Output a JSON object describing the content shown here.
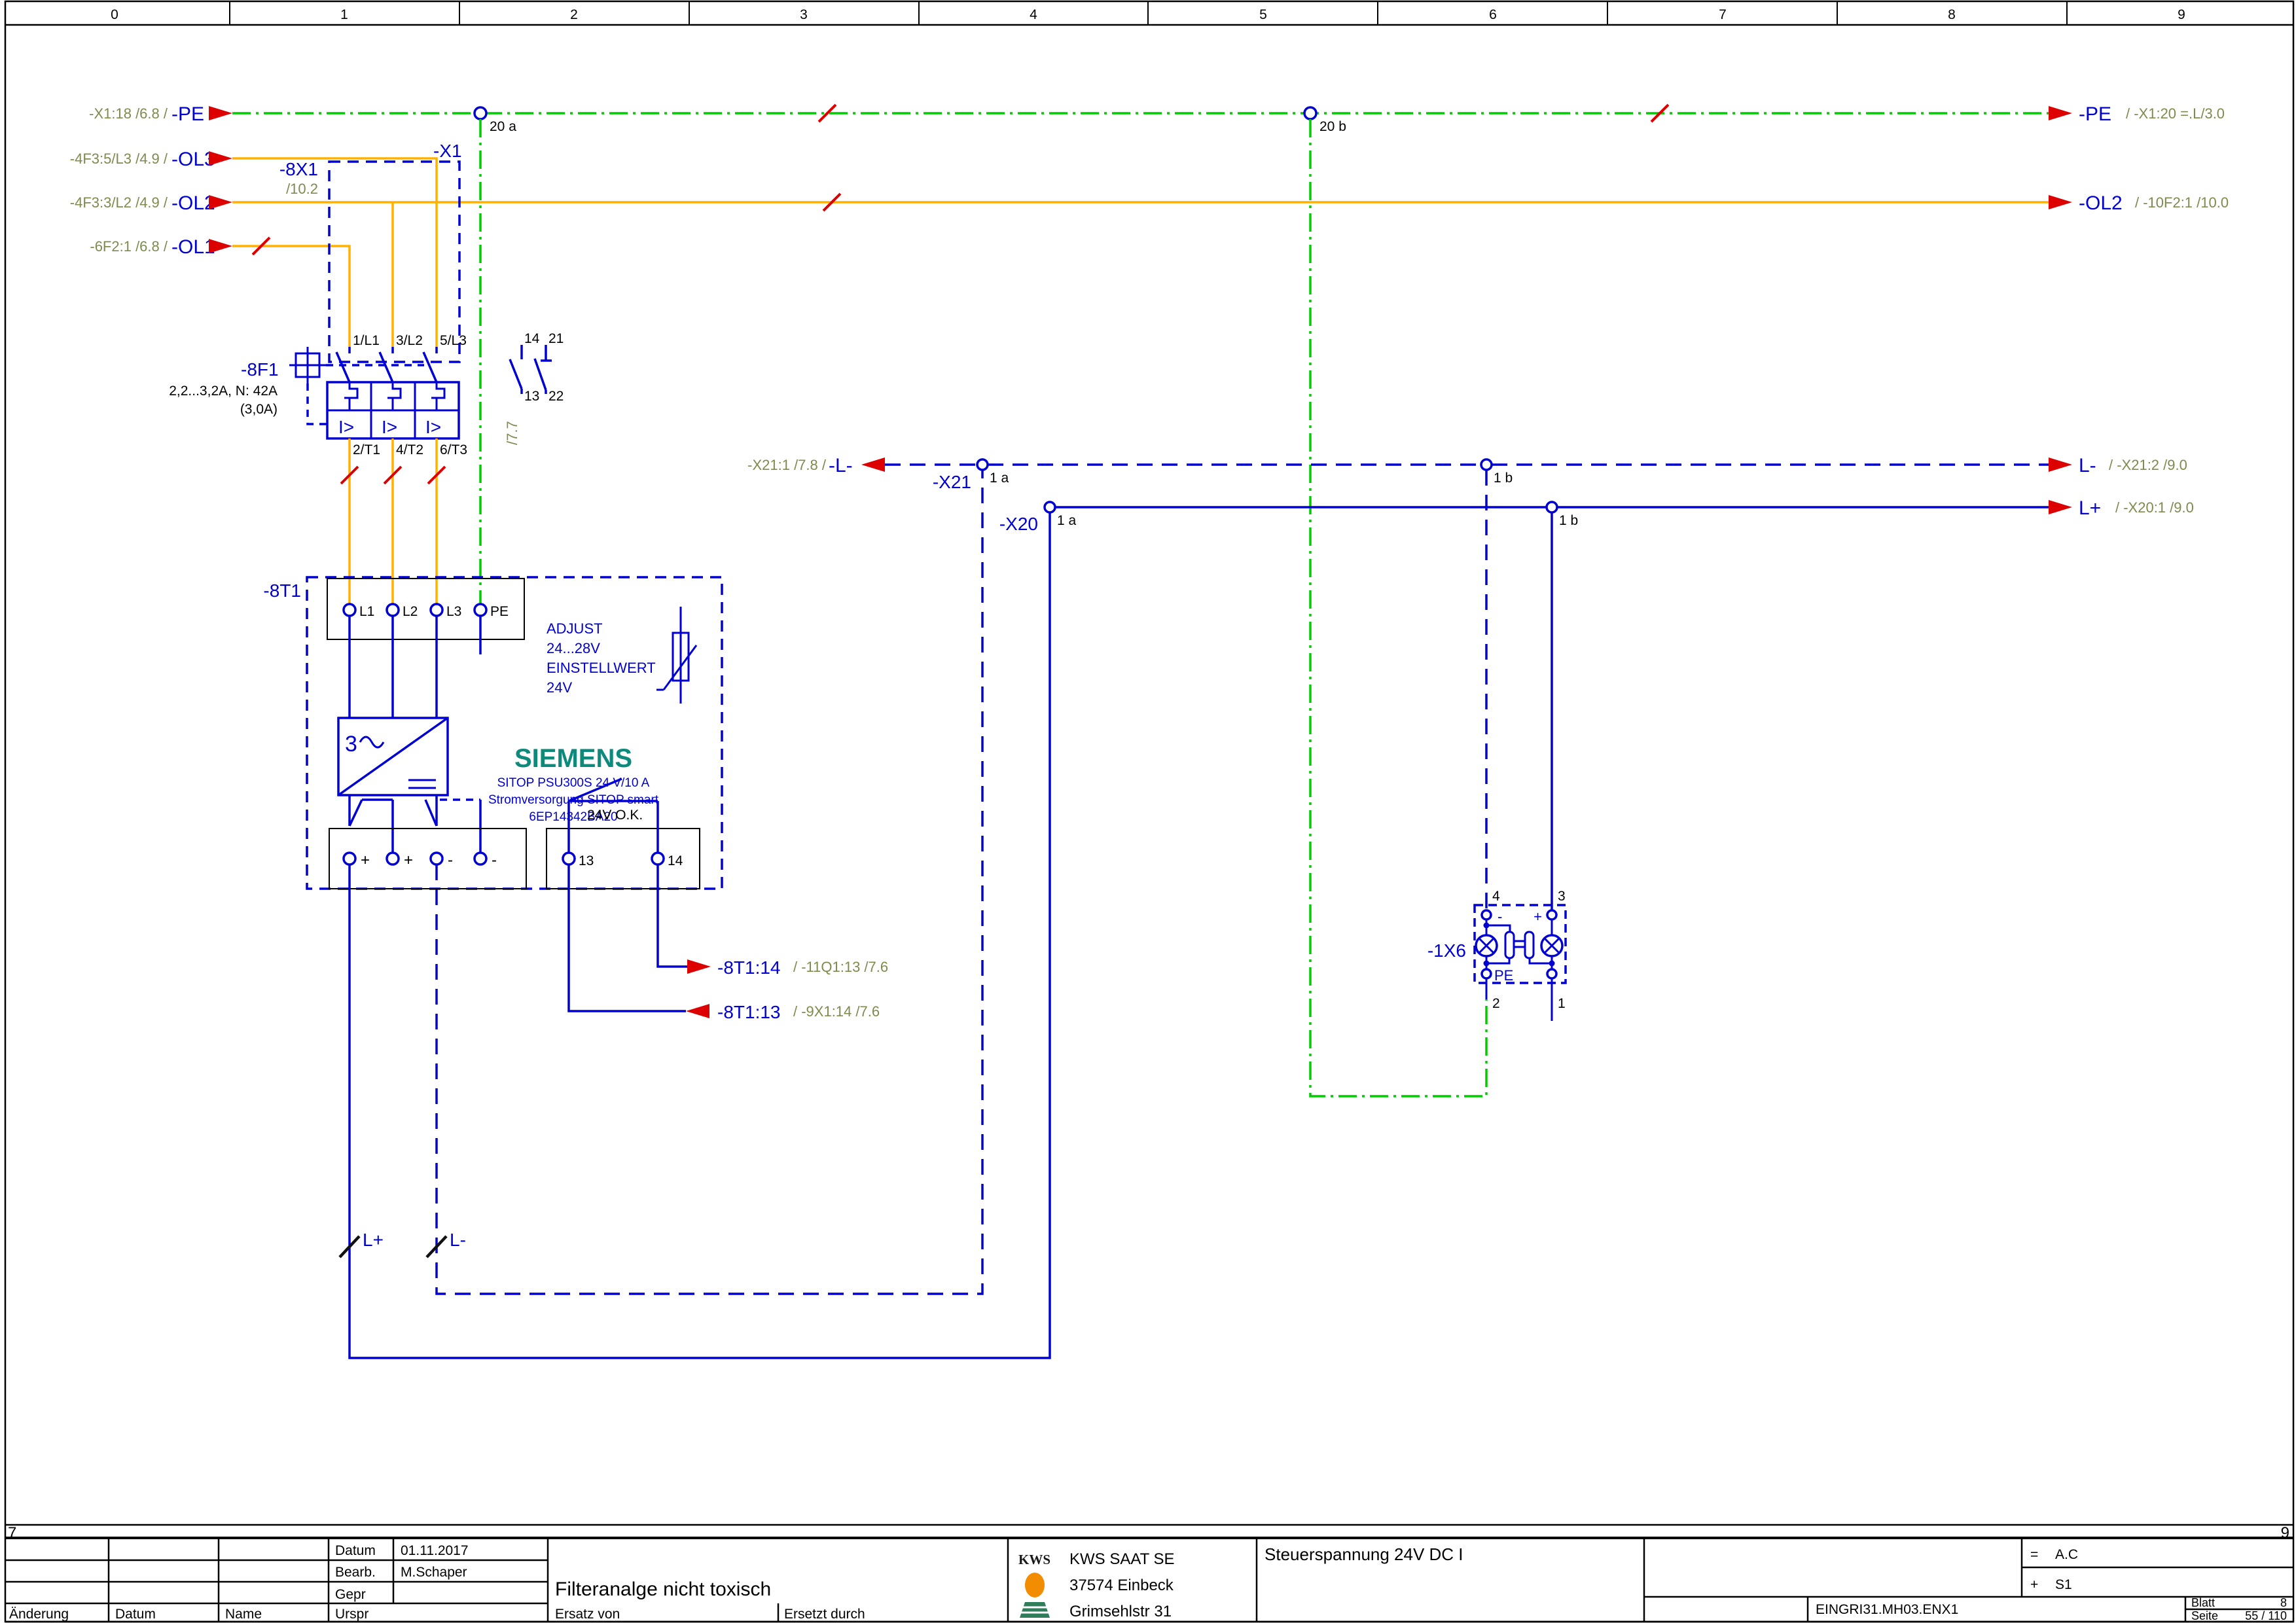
{
  "ruler": {
    "cols": [
      "0",
      "1",
      "2",
      "3",
      "4",
      "5",
      "6",
      "7",
      "8",
      "9"
    ],
    "bottom_left": "7",
    "bottom_right": "9"
  },
  "colors": {
    "wire_blue": "#0000d2",
    "wire_green": "#00cc00",
    "wire_orange": "#ffb000",
    "arrow_red": "#dd0000",
    "ref_text": "#7d8b4e",
    "siemens_teal": "#0e8a7d",
    "kws_orange": "#f28c00",
    "kws_green": "#2f7d5a"
  },
  "pe_row": {
    "left_ref": "-X1:18 /6.8 /",
    "left_name": "-PE",
    "right_name": "-PE",
    "right_ref": "/ -X1:20 =.L/3.0",
    "term_a": "20 a",
    "term_b": "20 b"
  },
  "ol3_row": {
    "left_ref": "-4F3:5/L3 /4.9 /",
    "left_name": "-OL3"
  },
  "ol2_row": {
    "left_ref": "-4F3:3/L2 /4.9 /",
    "left_name": "-OL2",
    "right_name": "-OL2",
    "right_ref": "/ -10F2:1 /10.0"
  },
  "ol1_row": {
    "left_ref": "-6F2:1 /6.8 /",
    "left_name": "-OL1"
  },
  "x1": {
    "name": "-X1",
    "sub_name": "-8X1",
    "sub_ref": "/10.2"
  },
  "f1": {
    "name": "-8F1",
    "rating": "2,2...3,2A, N:  42A",
    "rating2": "(3,0A)",
    "poles_top": [
      "1/L1",
      "3/L2",
      "5/L3"
    ],
    "poles_bottom": [
      "2/T1",
      "4/T2",
      "6/T3"
    ],
    "trip": "I>",
    "aux": [
      "14",
      "21",
      "13",
      "22"
    ],
    "aux_ref": "/7.7"
  },
  "t1": {
    "name": "-8T1",
    "in_terms": [
      "L1",
      "L2",
      "L3",
      "PE"
    ],
    "adjust": [
      "ADJUST",
      "24...28V",
      "EINSTELLWERT",
      "24V"
    ],
    "conv_num": "3",
    "brand": "SIEMENS",
    "product": "SITOP PSU300S 24 V/10 A",
    "product2": "Stromversorgung SITOP smart",
    "product3": "6EP14342BA20",
    "out_terms": [
      "+",
      "+",
      "-",
      "-"
    ],
    "ok_label": "24V O.K.",
    "ok_terms": [
      "13",
      "14"
    ],
    "pot_plus": "L+",
    "pot_minus": "L-"
  },
  "t1_refs": {
    "t14_name": "-8T1:14",
    "t14_ref": "/ -11Q1:13 /7.6",
    "t13_name": "-8T1:13",
    "t13_ref": "/ -9X1:14 /7.6"
  },
  "x21": {
    "name": "-X21",
    "term_a": "1 a",
    "term_b": "1 b",
    "left_ref": "-X21:1 /7.8 /",
    "left_name": "-L-",
    "right_name": "L-",
    "right_ref": "/ -X21:2 /9.0"
  },
  "x20": {
    "name": "-X20",
    "term_a": "1 a",
    "term_b": "1 b",
    "right_name": "L+",
    "right_ref": "/ -X20:1 /9.0"
  },
  "x6": {
    "name": "-1X6",
    "pins": [
      "4",
      "3",
      "2",
      "1"
    ],
    "minus": "-",
    "plus": "+",
    "pe": "PE"
  },
  "titleblock": {
    "datum_label": "Datum",
    "datum": "01.11.2017",
    "bearb_label": "Bearb.",
    "bearb": "M.Schaper",
    "gepr_label": "Gepr",
    "urspr_label": "Urspr",
    "aenderung_label": "Änderung",
    "datum2_label": "Datum",
    "name_label": "Name",
    "title": "Filteranalge nicht toxisch",
    "ersatz_label": "Ersatz von",
    "ersetzt_label": "Ersetzt durch",
    "kws": "KWS",
    "company": "KWS SAAT SE",
    "city": "37574 Einbeck",
    "street": "Grimsehlstr 31",
    "subject": "Steuerspannung 24V DC I",
    "eq_sym": "=",
    "eq_val": "A.C",
    "plus_sym": "+",
    "plus_val": "S1",
    "doc": "EINGRI31.MH03.ENX1",
    "blatt_label": "Blatt",
    "blatt": "8",
    "seite_label": "Seite",
    "seite": "55 / 110"
  }
}
